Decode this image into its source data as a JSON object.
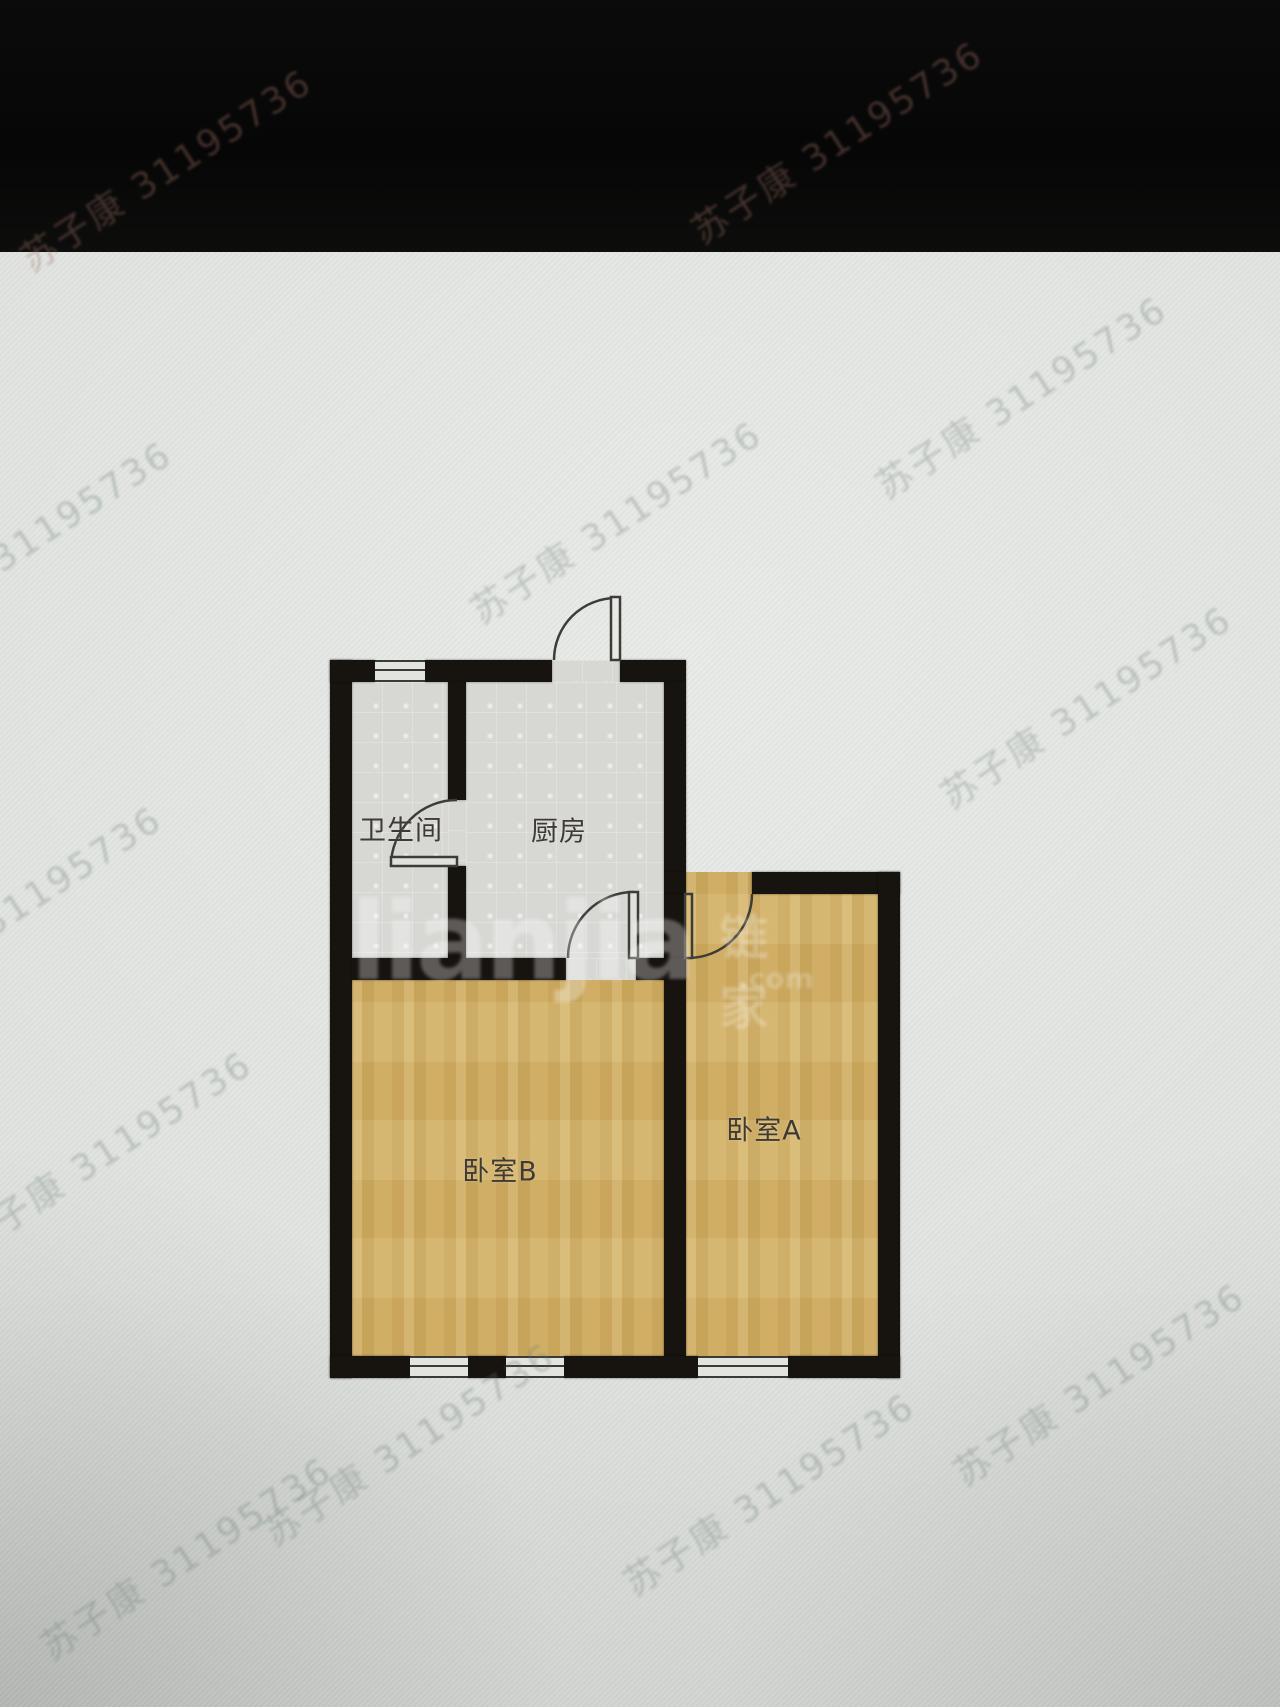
{
  "floorplan": {
    "rooms": {
      "bathroom": {
        "label": "卫生间"
      },
      "kitchen": {
        "label": "厨房"
      },
      "bedroom_b": {
        "label": "卧室B"
      },
      "bedroom_a": {
        "label": "卧室A"
      }
    }
  },
  "brand_watermark": {
    "latin": "lianjia",
    "cn": "链家",
    "suffix": ".com"
  },
  "watermark": {
    "text": "苏子康 31195736",
    "positions": [
      {
        "x": 165,
        "y": 168,
        "zone": "dark"
      },
      {
        "x": 836,
        "y": 140,
        "zone": "dark"
      },
      {
        "x": 615,
        "y": 520,
        "zone": "light"
      },
      {
        "x": 1020,
        "y": 395,
        "zone": "light"
      },
      {
        "x": 1085,
        "y": 705,
        "zone": "light"
      },
      {
        "x": 25,
        "y": 540,
        "zone": "light"
      },
      {
        "x": 15,
        "y": 905,
        "zone": "light"
      },
      {
        "x": 105,
        "y": 1150,
        "zone": "light"
      },
      {
        "x": 185,
        "y": 1556,
        "zone": "light"
      },
      {
        "x": 408,
        "y": 1442,
        "zone": "light"
      },
      {
        "x": 768,
        "y": 1492,
        "zone": "light"
      },
      {
        "x": 1098,
        "y": 1382,
        "zone": "light"
      }
    ]
  },
  "colors": {
    "background_light": "#dfe2df",
    "top_band": "#070707",
    "wall": "#17130f",
    "tile_floor": "#d7d8d4",
    "wood_floor": "#d1ae62",
    "door_line": "#3c3c38"
  }
}
